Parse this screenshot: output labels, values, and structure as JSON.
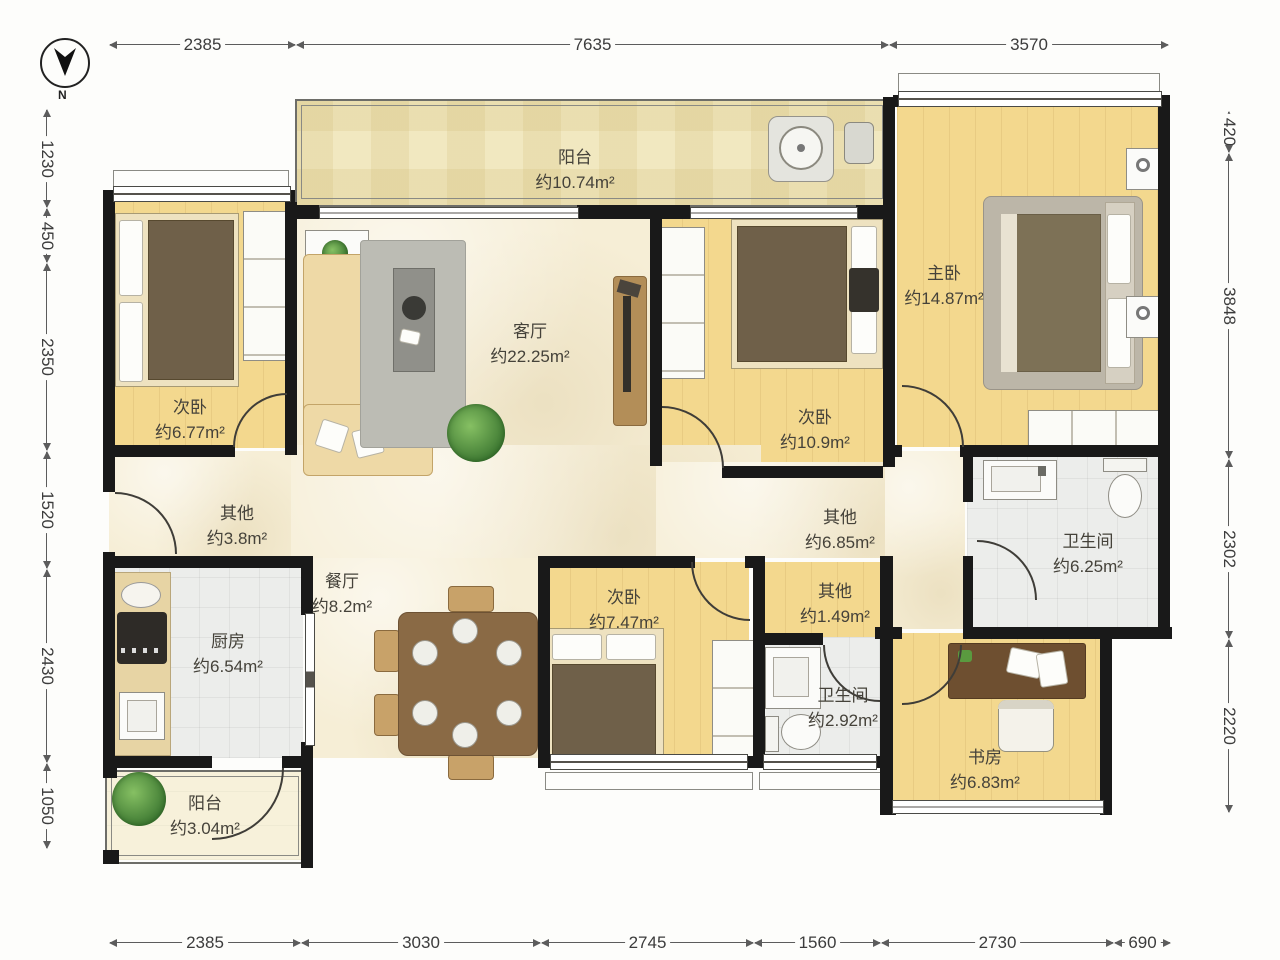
{
  "compass": {
    "label": "N"
  },
  "dimensions": {
    "top": [
      "2385",
      "7635",
      "3570"
    ],
    "bottom": [
      "2385",
      "3030",
      "2745",
      "1560",
      "2730",
      "690"
    ],
    "left": [
      "1230",
      "450",
      "2350",
      "1520",
      "2430",
      "1050"
    ],
    "right": [
      "420",
      "3848",
      "2302",
      "2220"
    ]
  },
  "rooms": [
    {
      "id": "balcony-top",
      "name": "阳台",
      "area": "约10.74m²"
    },
    {
      "id": "bedroom-left",
      "name": "次卧",
      "area": "约6.77m²"
    },
    {
      "id": "living-room",
      "name": "客厅",
      "area": "约22.25m²"
    },
    {
      "id": "bedroom-mid",
      "name": "次卧",
      "area": "约10.9m²"
    },
    {
      "id": "master-bedroom",
      "name": "主卧",
      "area": "约14.87m²"
    },
    {
      "id": "other-entry",
      "name": "其他",
      "area": "约3.8m²"
    },
    {
      "id": "dining-room",
      "name": "餐厅",
      "area": "约8.2m²"
    },
    {
      "id": "other-hall",
      "name": "其他",
      "area": "约6.85m²"
    },
    {
      "id": "bathroom-main",
      "name": "卫生间",
      "area": "约6.25m²"
    },
    {
      "id": "bedroom-small",
      "name": "次卧",
      "area": "约7.47m²"
    },
    {
      "id": "other-small",
      "name": "其他",
      "area": "约1.49m²"
    },
    {
      "id": "kitchen",
      "name": "厨房",
      "area": "约6.54m²"
    },
    {
      "id": "bathroom-small",
      "name": "卫生间",
      "area": "约2.92m²"
    },
    {
      "id": "study",
      "name": "书房",
      "area": "约6.83m²"
    },
    {
      "id": "balcony-bottom",
      "name": "阳台",
      "area": "约3.04m²"
    }
  ],
  "colors": {
    "wall": "#191919",
    "wood_floor": "#f3d88e",
    "cream_floor": "#f6eed6",
    "tile_floor": "#ecedeb",
    "balcony_floor": "#f1e8c0",
    "blanket": "#6f6049",
    "plant": "#3f7a33",
    "dimension_text": "#3c3c3c"
  }
}
